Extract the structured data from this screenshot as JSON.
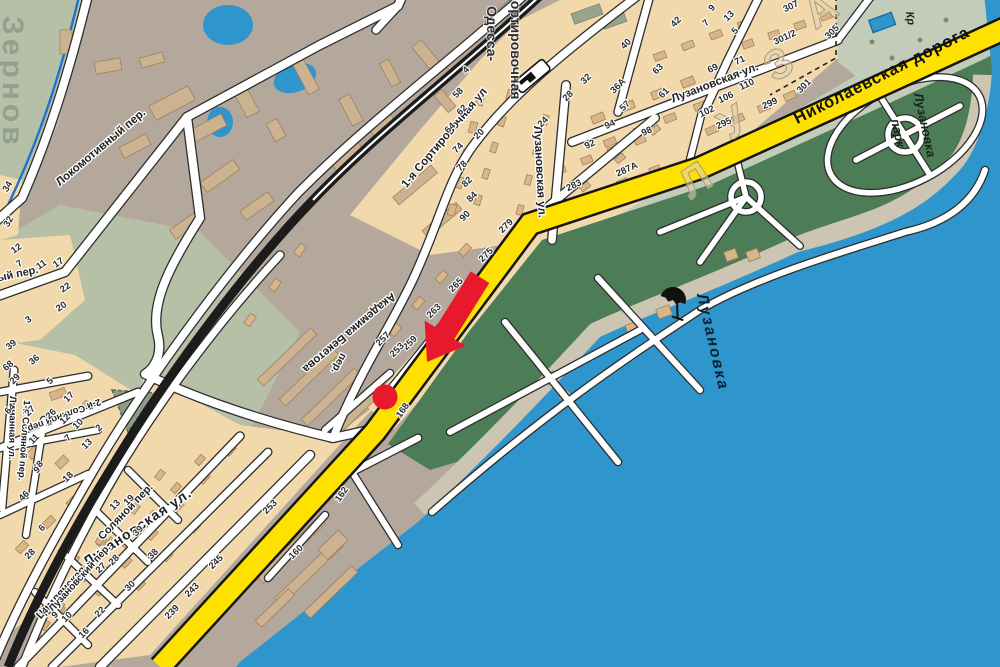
{
  "map": {
    "kind": "city-street-map",
    "language": "ru",
    "area_shown": "Лузановка",
    "water_body_label": "Лузановка",
    "park_label_line1": "парк",
    "park_label_line2": "Лузановка",
    "railway_label_line1": "Одесса-",
    "railway_label_line2": "-Сортировочная",
    "main_road_label": "Николаевская дорога",
    "district_big_letters": [
      "Л",
      "У",
      "З",
      "А"
    ],
    "area_big_label": "Зернов"
  },
  "colors": {
    "sea": "#2e96cd",
    "sage": "#b6c0a7",
    "base": "#b3a89b",
    "tan": "#f2d9ac",
    "park": "#4d7d57",
    "beach": "#cbc5b1",
    "pale": "#c2ccb8",
    "yellow": "#ffe100",
    "building": "#d8b68a",
    "red_marker": "#e8192c",
    "rail": "#1c1c1c",
    "stream": "#1d72cf"
  },
  "icons": {
    "station": "railway-station-icon",
    "umbrella": "beach-umbrella-icon",
    "pool": "swimming-pool-rect",
    "marker_arrow": "red-arrow-marker",
    "marker_dot": "red-dot-marker"
  },
  "street_labels": [
    {
      "t": "Локомотивный пер.",
      "x": 103,
      "y": 150,
      "r": -40,
      "s": 11.5,
      "c": "street"
    },
    {
      "t": "Локомотивный пер.",
      "x": -14,
      "y": 284,
      "r": -12,
      "s": 11,
      "c": "street"
    },
    {
      "t": "Одесса-",
      "x": 487,
      "y": 6,
      "r": 90,
      "s": 14,
      "c": "station",
      "a": "start"
    },
    {
      "t": "-Сортировочная",
      "x": 511,
      "y": -14,
      "r": 90,
      "s": 14,
      "c": "station",
      "a": "start"
    },
    {
      "t": "1-я Сортировочная ул",
      "x": 447,
      "y": 140,
      "r": -50,
      "s": 11.5,
      "c": "street"
    },
    {
      "t": "Лузановская ул.",
      "x": 534,
      "y": 126,
      "r": 87,
      "s": 11.5,
      "c": "street",
      "a": "start"
    },
    {
      "t": "Лузановская ул.",
      "x": 716,
      "y": 86,
      "r": -21,
      "s": 11.5,
      "c": "street"
    },
    {
      "t": "Николаевская дорога",
      "x": 884,
      "y": 80,
      "r": -27,
      "s": 16.5,
      "c": "mainroad"
    },
    {
      "t": "парк",
      "x": 891,
      "y": 120,
      "r": 78,
      "s": 12.5,
      "c": "park-lbl",
      "a": "start"
    },
    {
      "t": "Лузановка",
      "x": 914,
      "y": 94,
      "r": 78,
      "s": 12.5,
      "c": "park-lbl",
      "a": "start"
    },
    {
      "t": "Лузановка",
      "x": 697,
      "y": 295,
      "r": 77,
      "s": 15.5,
      "c": "water-lbl",
      "a": "start"
    },
    {
      "t": "Академика Бекетова",
      "x": 347,
      "y": 330,
      "r": 140,
      "s": 11.5,
      "c": "street"
    },
    {
      "t": "пер.",
      "x": 336,
      "y": 362,
      "r": 118,
      "s": 10.5,
      "c": "street"
    },
    {
      "t": "Соляной пер.",
      "x": 128,
      "y": 514,
      "r": -46,
      "s": 11,
      "c": "street"
    },
    {
      "t": "Цимлянская ул.",
      "x": 70,
      "y": 588,
      "r": -47,
      "s": 11,
      "c": "street"
    },
    {
      "t": "1-й Соляной пер.",
      "x": 24,
      "y": 400,
      "r": 94,
      "s": 9.5,
      "c": "street",
      "a": "start"
    },
    {
      "t": "2-й Соляной пер.",
      "x": 62,
      "y": 413,
      "r": 159,
      "s": 9.5,
      "c": "street"
    },
    {
      "t": "Лузановская ул.",
      "x": 140,
      "y": 531,
      "r": -34,
      "s": 14,
      "c": "street-big"
    },
    {
      "t": "Лузановский пер.",
      "x": 82,
      "y": 580,
      "r": -48,
      "s": 10,
      "c": "street"
    },
    {
      "t": "Лиманная ул.",
      "x": 10,
      "y": 396,
      "r": 91,
      "s": 9.5,
      "c": "street",
      "a": "start"
    },
    {
      "t": "Зернов",
      "x": 3,
      "y": 16,
      "r": 90,
      "s": 30,
      "c": "area-lbl",
      "a": "start"
    },
    {
      "t": "Л",
      "x": 703,
      "y": 192,
      "r": -33,
      "s": 42,
      "c": "district-lbl"
    },
    {
      "t": "У",
      "x": 741,
      "y": 134,
      "r": -33,
      "s": 42,
      "c": "district-lbl"
    },
    {
      "t": "З",
      "x": 786,
      "y": 76,
      "r": -33,
      "s": 42,
      "c": "district-lbl"
    },
    {
      "t": "А",
      "x": 828,
      "y": 22,
      "r": -33,
      "s": 42,
      "c": "district-lbl"
    },
    {
      "t": "Кр",
      "x": 906,
      "y": 12,
      "r": 82,
      "s": 11,
      "c": "park-lbl",
      "a": "start"
    }
  ],
  "house_numbers": [
    [
      "4",
      468,
      72,
      -45
    ],
    [
      "58",
      460,
      95,
      -45
    ],
    [
      "62",
      464,
      112,
      -45
    ],
    [
      "64",
      452,
      130,
      -45
    ],
    [
      "74",
      460,
      150,
      -45
    ],
    [
      "78",
      464,
      168,
      -45
    ],
    [
      "82",
      469,
      184,
      -45
    ],
    [
      "84",
      474,
      199,
      -45
    ],
    [
      "90",
      467,
      218,
      -45
    ],
    [
      "20",
      481,
      136,
      -45
    ],
    [
      "24",
      545,
      124,
      -45
    ],
    [
      "28",
      570,
      98,
      -45
    ],
    [
      "32",
      588,
      81,
      -45
    ],
    [
      "40",
      628,
      46,
      -45
    ],
    [
      "36А",
      620,
      88,
      -45
    ],
    [
      "57",
      627,
      108,
      -45
    ],
    [
      "63",
      660,
      71,
      -45
    ],
    [
      "61",
      666,
      95,
      -45
    ],
    [
      "69",
      714,
      71,
      -25
    ],
    [
      "71",
      741,
      63,
      -25
    ],
    [
      "110",
      748,
      87,
      -25
    ],
    [
      "106",
      727,
      100,
      -25
    ],
    [
      "102",
      708,
      114,
      -25
    ],
    [
      "98",
      648,
      134,
      -25
    ],
    [
      "94",
      611,
      127,
      -25
    ],
    [
      "92",
      591,
      147,
      -25
    ],
    [
      "287А",
      628,
      172,
      -25
    ],
    [
      "283",
      575,
      188,
      -25
    ],
    [
      "295",
      725,
      126,
      -25
    ],
    [
      "299",
      771,
      106,
      -25
    ],
    [
      "301",
      806,
      88,
      -45
    ],
    [
      "305",
      834,
      34,
      -45
    ],
    [
      "301/2",
      786,
      40,
      -25
    ],
    [
      "307",
      792,
      9,
      -25
    ],
    [
      "42",
      678,
      24,
      -45
    ],
    [
      "13",
      731,
      18,
      -45
    ],
    [
      "9",
      714,
      10,
      -45
    ],
    [
      "7",
      708,
      25,
      -45
    ],
    [
      "5",
      737,
      33,
      -45
    ],
    [
      "279",
      508,
      228,
      -45
    ],
    [
      "275",
      488,
      257,
      -45
    ],
    [
      "265",
      458,
      287,
      -45
    ],
    [
      "263",
      436,
      313,
      -45
    ],
    [
      "259",
      412,
      345,
      -45
    ],
    [
      "257",
      385,
      341,
      -45
    ],
    [
      "253",
      399,
      352,
      -45
    ],
    [
      "253",
      272,
      509,
      -45
    ],
    [
      "245",
      218,
      564,
      -45
    ],
    [
      "243",
      194,
      592,
      -45
    ],
    [
      "239",
      174,
      614,
      -45
    ],
    [
      "168",
      405,
      412,
      -55
    ],
    [
      "162",
      344,
      496,
      -55
    ],
    [
      "160",
      298,
      554,
      -45
    ],
    [
      "13",
      117,
      507,
      -45
    ],
    [
      "19",
      131,
      502,
      -45
    ],
    [
      "39",
      140,
      533,
      -45
    ],
    [
      "38",
      155,
      556,
      -45
    ],
    [
      "30",
      132,
      588,
      -45
    ],
    [
      "28",
      116,
      562,
      -45
    ],
    [
      "27",
      103,
      570,
      -45
    ],
    [
      "22",
      102,
      614,
      -45
    ],
    [
      "16",
      86,
      635,
      -45
    ],
    [
      "10",
      69,
      619,
      -45
    ],
    [
      "9",
      57,
      617,
      -45
    ],
    [
      "4",
      47,
      613,
      -45
    ],
    [
      "48",
      40,
      468,
      -45
    ],
    [
      "46",
      26,
      498,
      -45
    ],
    [
      "18",
      70,
      479,
      -45
    ],
    [
      "9",
      39,
      472,
      -45
    ],
    [
      "6",
      44,
      530,
      -45
    ],
    [
      "28",
      32,
      556,
      -45
    ],
    [
      "29",
      17,
      381,
      -45
    ],
    [
      "5",
      52,
      383,
      -45
    ],
    [
      "17",
      71,
      399,
      -45
    ],
    [
      "64",
      12,
      411,
      -45
    ],
    [
      "27",
      32,
      413,
      -45
    ],
    [
      "26",
      53,
      416,
      -45
    ],
    [
      "12",
      67,
      421,
      -45
    ],
    [
      "10",
      80,
      426,
      -45
    ],
    [
      "2",
      101,
      430,
      -45
    ],
    [
      "7",
      70,
      440,
      -45
    ],
    [
      "13",
      89,
      446,
      -45
    ],
    [
      "11",
      36,
      441,
      -45
    ],
    [
      "34",
      10,
      188,
      -60
    ],
    [
      "32",
      11,
      223,
      -60
    ],
    [
      "12",
      18,
      251,
      -35
    ],
    [
      "7",
      21,
      266,
      -35
    ],
    [
      "11",
      43,
      267,
      -35
    ],
    [
      "17",
      60,
      265,
      -35
    ],
    [
      "22",
      67,
      290,
      -35
    ],
    [
      "20",
      63,
      309,
      -35
    ],
    [
      "3",
      30,
      322,
      -35
    ],
    [
      "39",
      13,
      347,
      -40
    ],
    [
      "68",
      10,
      368,
      -40
    ],
    [
      "36",
      36,
      362,
      -40
    ]
  ]
}
